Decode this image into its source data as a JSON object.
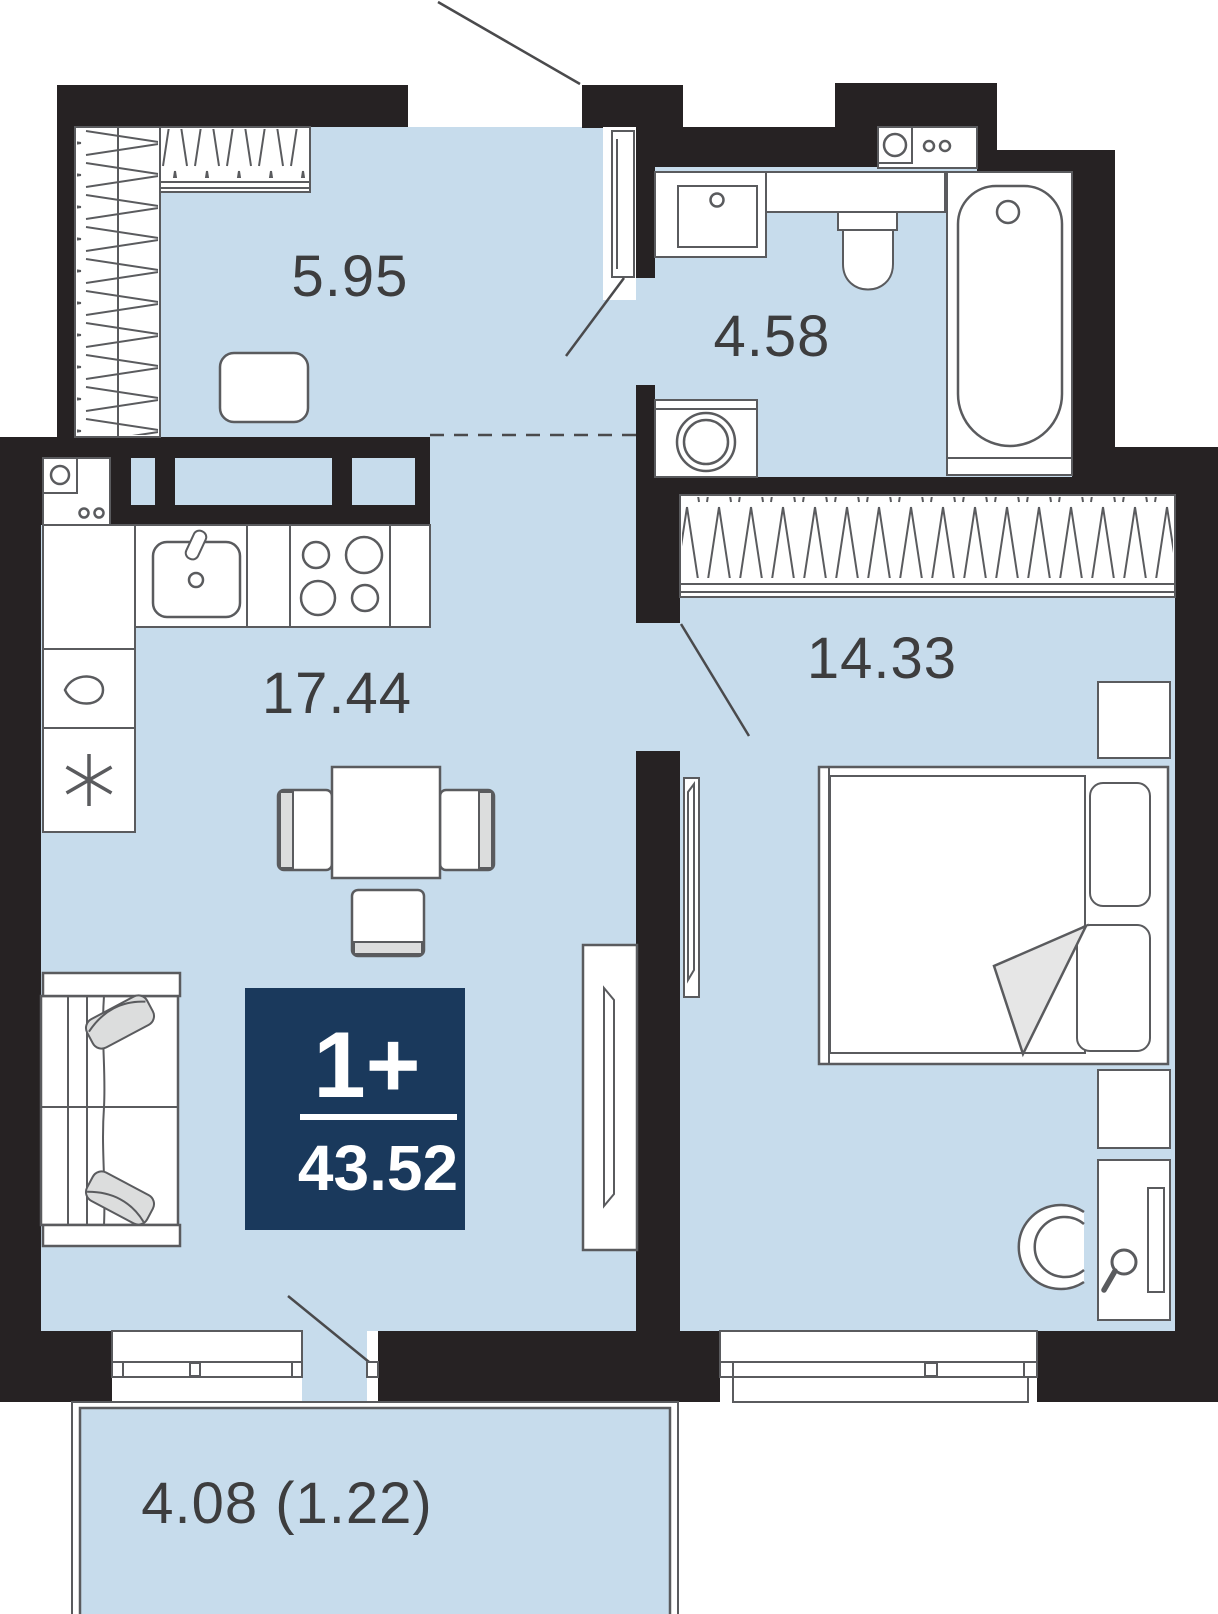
{
  "plan": {
    "title": "apartment-floor-plan",
    "rooms": [
      {
        "id": "hallway",
        "area_label": "5.95"
      },
      {
        "id": "bathroom",
        "area_label": "4.58"
      },
      {
        "id": "kitchen_living",
        "area_label": "17.44"
      },
      {
        "id": "bedroom",
        "area_label": "14.33"
      },
      {
        "id": "balcony",
        "area_label": "4.08 (1.22)"
      }
    ],
    "badge": {
      "rooms_label": "1+",
      "total_area": "43.52"
    },
    "furniture_icons": [
      "wardrobe-icon",
      "pouf-icon",
      "kitchen-sink-icon",
      "stove-icon",
      "fridge-icon",
      "kettle-icon",
      "boiler-icon",
      "dining-table-icon",
      "chair-icon",
      "sofa-icon",
      "tv-icon",
      "vanity-sink-icon",
      "toilet-icon",
      "bathtub-icon",
      "washing-machine-icon",
      "bed-icon",
      "nightstand-icon",
      "desk-icon",
      "desk-chair-icon",
      "hand-mirror-icon",
      "wall-mirror-icon",
      "door-swing",
      "window"
    ],
    "colors": {
      "floor": "#c7dcec",
      "wall": "#262223",
      "badge_bg": "#1a395c",
      "badge_text": "#ffffff",
      "furniture_stroke": "#5a5b5e",
      "accent_gray": "#dcdddd",
      "label_text": "#3d3d3e"
    }
  }
}
